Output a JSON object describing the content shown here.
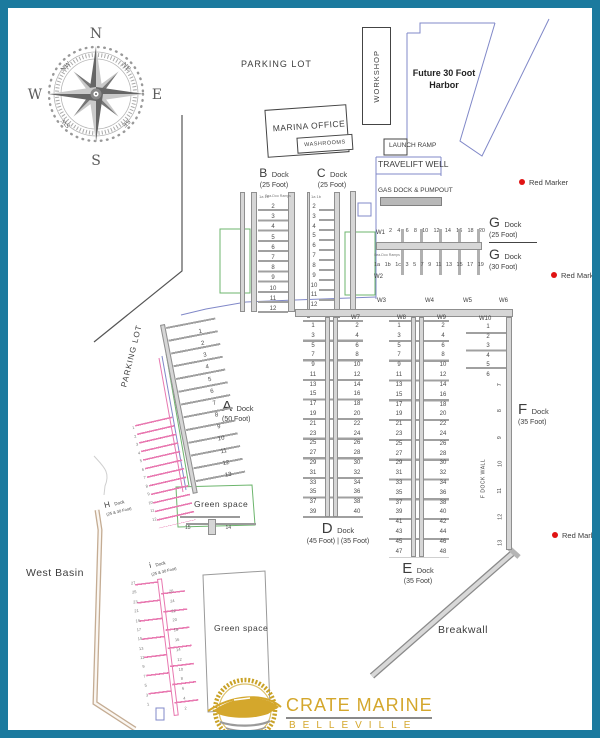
{
  "border_color": "#1b7a9e",
  "compass": {
    "n": "N",
    "e": "E",
    "s": "S",
    "w": "W",
    "ne": "NE",
    "se": "SE",
    "sw": "SW",
    "nw": "NW"
  },
  "labels": {
    "parking_top": "PARKING LOT",
    "parking_side": "PARKING LOT",
    "workshop": "WORKSHOP",
    "future_harbor": "Future 30 Foot Harbor",
    "marina_office": "MARINA OFFICE",
    "washrooms": "WASHROOMS",
    "launch_ramp": "LAUNCH RAMP",
    "travelift_well": "TRAVELIFT WELL",
    "gas_dock": "GAS DOCK & PUMPOUT",
    "west_basin": "West Basin",
    "breakwall": "Breakwall",
    "green_space": "Green space",
    "f_dock_wall": "F DOCK WALL",
    "sea_doo_ramps": "Sea-Doo Ramps",
    "red_marker": "Red Marker"
  },
  "walkways": {
    "w1": "W1",
    "w2": "W2",
    "w3": "W3",
    "w4": "W4",
    "w5": "W5",
    "w6": "W6",
    "w7": "W7",
    "w8": "W8",
    "w9": "W9",
    "w10": "W10"
  },
  "docks": {
    "a": {
      "letter": "A",
      "word": "Dock",
      "size": "(50 Foot)",
      "slips": [
        "1",
        "2",
        "3",
        "4",
        "5",
        "6",
        "7",
        "8",
        "9",
        "10",
        "11",
        "12",
        "13"
      ],
      "end_slips": [
        "15",
        "14"
      ]
    },
    "b": {
      "letter": "B",
      "word": "Dock",
      "size": "(25 Foot)",
      "ramp_slips": "1a 1b",
      "slips": [
        "2",
        "3",
        "4",
        "5",
        "6",
        "7",
        "8",
        "9",
        "10",
        "11",
        "12"
      ]
    },
    "c": {
      "letter": "C",
      "word": "Dock",
      "size": "(25 Foot)",
      "ramp_slips": "1a 1b",
      "slips": [
        "2",
        "3",
        "4",
        "5",
        "6",
        "7",
        "8",
        "9",
        "10",
        "11",
        "12",
        "13"
      ]
    },
    "d": {
      "letter": "D",
      "word": "Dock",
      "size": "(45 Foot)  |  (35 Foot)",
      "left": [
        "1",
        "3",
        "5",
        "7",
        "9",
        "11",
        "13",
        "15",
        "17",
        "19",
        "21",
        "23",
        "25",
        "27",
        "29",
        "31",
        "33",
        "35",
        "37",
        "39"
      ],
      "right": [
        "2",
        "4",
        "6",
        "8",
        "10",
        "12",
        "14",
        "16",
        "18",
        "20",
        "22",
        "24",
        "26",
        "28",
        "30",
        "32",
        "34",
        "36",
        "38",
        "40"
      ]
    },
    "e": {
      "letter": "E",
      "word": "Dock",
      "size": "(35 Foot)",
      "left": [
        "1",
        "3",
        "5",
        "7",
        "9",
        "11",
        "13",
        "15",
        "17",
        "19",
        "21",
        "23",
        "25",
        "27",
        "29",
        "31",
        "33",
        "35",
        "37",
        "39",
        "41",
        "43",
        "45",
        "47"
      ],
      "right": [
        "2",
        "4",
        "6",
        "8",
        "10",
        "12",
        "14",
        "16",
        "18",
        "20",
        "22",
        "24",
        "26",
        "28",
        "30",
        "32",
        "34",
        "36",
        "38",
        "40",
        "42",
        "44",
        "46",
        "48"
      ]
    },
    "f": {
      "letter": "F",
      "word": "Dock",
      "size": "(35 Foot)",
      "top_slips": [
        "1",
        "2",
        "3",
        "4",
        "5",
        "6"
      ],
      "side_slips": [
        "7",
        "8",
        "9",
        "10",
        "11",
        "12",
        "13"
      ]
    },
    "g": {
      "letter": "G",
      "word": "Dock",
      "size_25": "(25 Foot)",
      "size_30": "(30 Foot)",
      "north_slips": [
        "2",
        "4",
        "6",
        "8",
        "10",
        "12",
        "14",
        "16",
        "18",
        "20"
      ],
      "south_slips": [
        "1a",
        "1b",
        "1c",
        "3",
        "5",
        "7",
        "9",
        "11",
        "13",
        "15",
        "17",
        "19"
      ]
    },
    "h": {
      "letter": "H",
      "word": "Dock",
      "size": "(25 & 30 Foot)",
      "slips": [
        "1",
        "2",
        "3",
        "4",
        "5",
        "6",
        "7",
        "8",
        "9",
        "10",
        "11",
        "12"
      ]
    },
    "i": {
      "letter": "i",
      "word": "Dock",
      "size": "(25 & 30 Foot)",
      "left": [
        "27",
        "25",
        "23",
        "21",
        "19",
        "17",
        "15",
        "13",
        "11",
        "9",
        "7",
        "5",
        "3",
        "1"
      ],
      "right": [
        "26",
        "24",
        "22",
        "20",
        "18",
        "16",
        "14",
        "12",
        "10",
        "8",
        "6",
        "4",
        "2"
      ]
    }
  },
  "logo": {
    "title": "CRATE MARINE",
    "subtitle": "BELLEVILLE"
  }
}
